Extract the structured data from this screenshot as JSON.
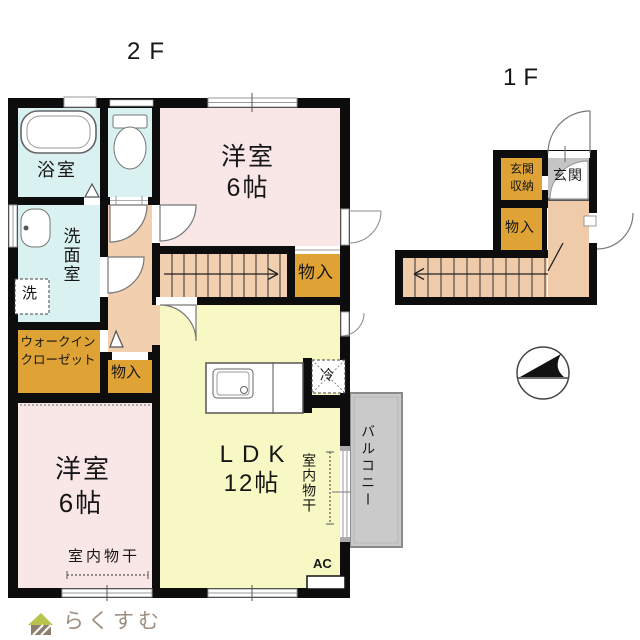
{
  "floor2": {
    "title": "2F",
    "rooms": {
      "bath": "浴室",
      "washroom": "洗面室",
      "laundry": "洗",
      "wic_line1": "ウォークイン",
      "wic_line2": "クローゼット",
      "hall_closet": "物入",
      "stairs_closet": "物入",
      "bedroom_upper_name": "洋室",
      "bedroom_upper_size": "6帖",
      "bedroom_lower_name": "洋室",
      "bedroom_lower_size": "6帖",
      "ldk_name": "LDK",
      "ldk_size": "12帖",
      "fridge": "冷",
      "balcony": "バルコニー",
      "ac_unit": "AC",
      "indoor_drying": "室内物干"
    }
  },
  "floor1": {
    "title": "1F",
    "rooms": {
      "entrance_storage_line1": "玄関",
      "entrance_storage_line2": "収納",
      "entrance": "玄関",
      "closet": "物入"
    }
  },
  "footer": {
    "logo_text": "らくすむ"
  },
  "colors": {
    "room_pink": "#f9e6e6",
    "room_cyan": "#d9f1f1",
    "hall_peach": "#f2cfae",
    "storage_orange": "#dfa335",
    "ldk_yellow": "#f8f8c4",
    "entrance_gray": "#c5c5c5",
    "balcony_gray": "#cacaca",
    "wall": "#0d0d0d"
  }
}
